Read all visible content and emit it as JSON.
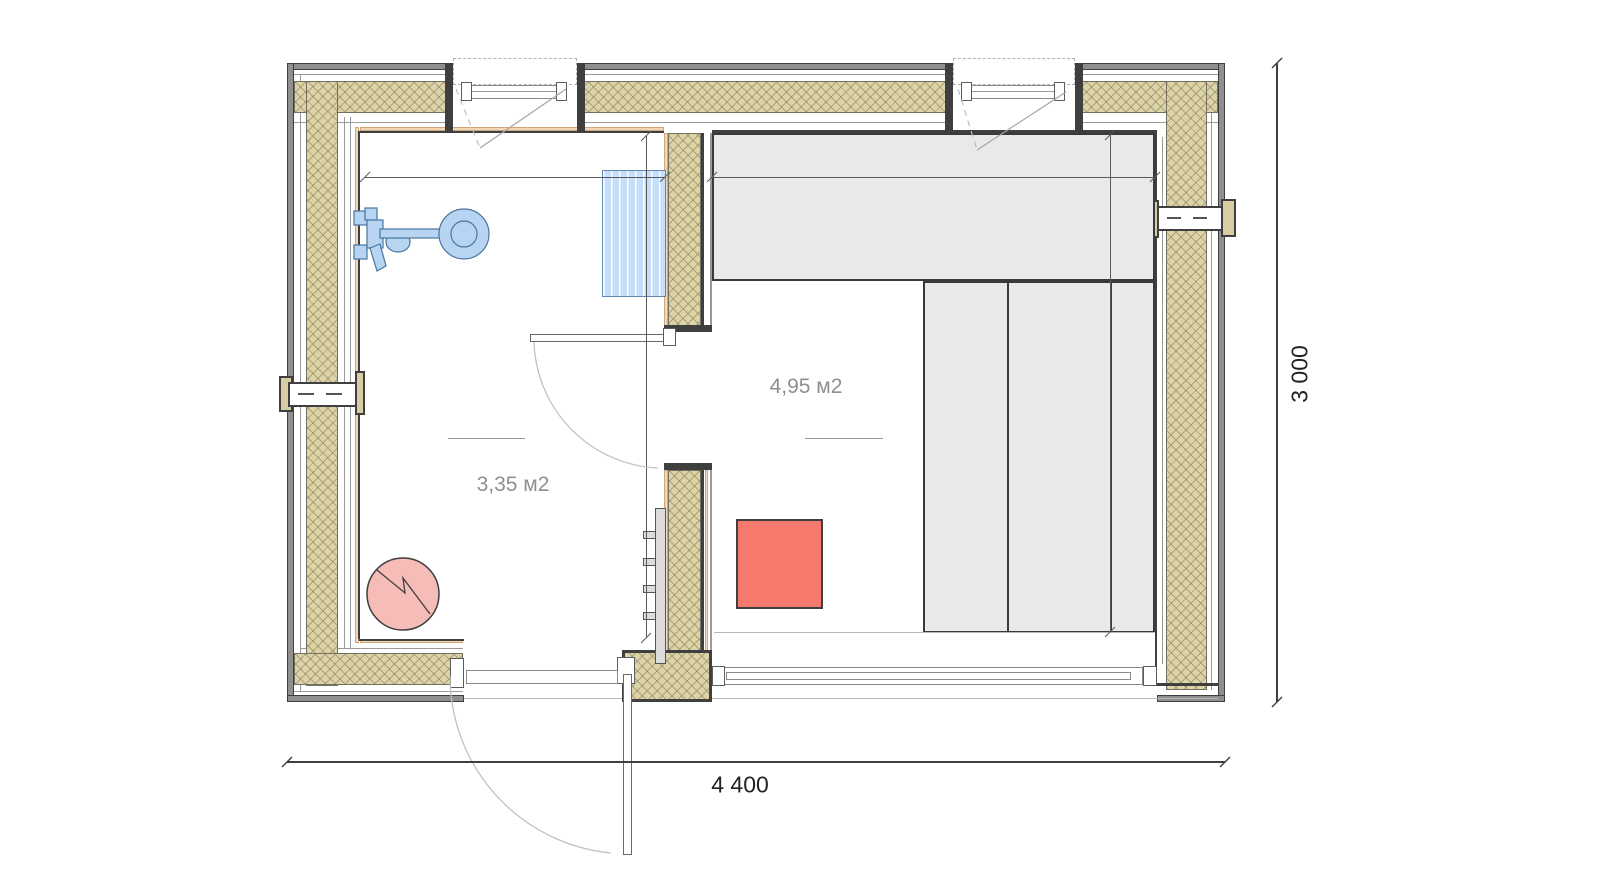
{
  "plan_title": "Sauna floor plan",
  "rooms": [
    {
      "id": "washroom",
      "area_label": "3,35 м2"
    },
    {
      "id": "sauna",
      "area_label": "4,95 м2"
    }
  ],
  "dimensions": {
    "width_label": "4 400",
    "height_label": "3 000"
  },
  "fixtures": [
    {
      "id": "shower-mixer"
    },
    {
      "id": "shower-head"
    },
    {
      "id": "towel-radiator"
    },
    {
      "id": "water-heater"
    },
    {
      "id": "sauna-stove"
    },
    {
      "id": "sauna-bench-upper"
    },
    {
      "id": "sauna-bench-lower"
    },
    {
      "id": "wall-vent-left"
    },
    {
      "id": "wall-vent-right"
    },
    {
      "id": "window-top-left"
    },
    {
      "id": "window-top-right"
    },
    {
      "id": "interior-door"
    },
    {
      "id": "entrance-door"
    },
    {
      "id": "glass-wall-bottom"
    }
  ],
  "colors": {
    "insulation_tan": "#ddd3a8",
    "fixture_blue": "#b7d5f3",
    "stove_red": "#f5796d",
    "heater_pink": "#f6bcb8",
    "bench_gray": "#e9e9e9",
    "liner_peach": "#f2d7b8",
    "wall_dark": "#3f3f3f"
  }
}
